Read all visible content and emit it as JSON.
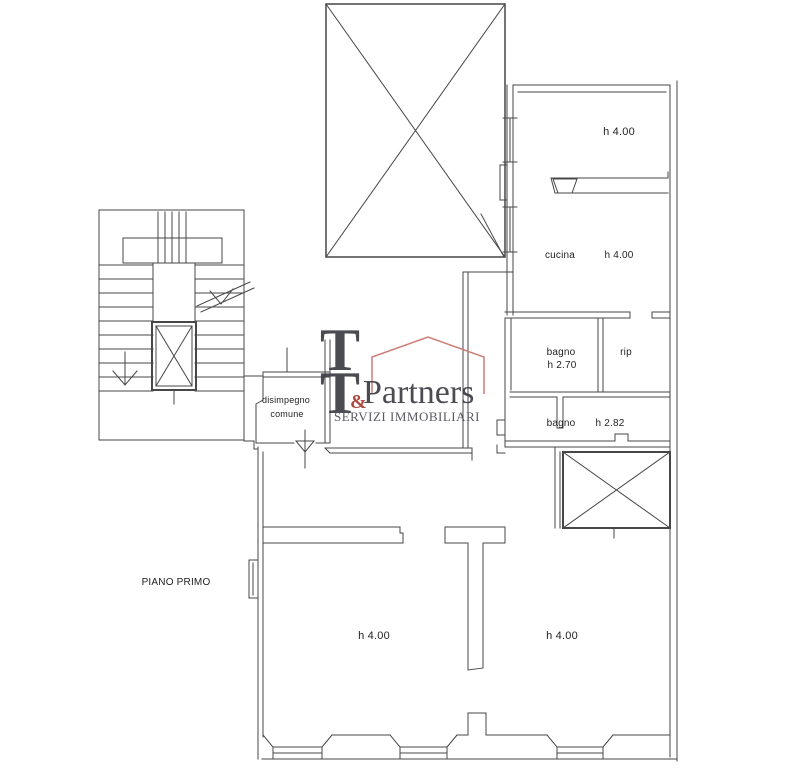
{
  "colors": {
    "bg": "#ffffff",
    "line": "#474747",
    "label": "#1f1f1f",
    "logo_dark": "#3c3c44",
    "logo_red": "#a93a32",
    "logo_house": "#cc7d75",
    "logo_sub": "#4c4c54"
  },
  "floor_label": "PIANO PRIMO",
  "rooms": {
    "top_right": {
      "height": "h 4.00"
    },
    "cucina": {
      "name": "cucina",
      "height": "h 4.00"
    },
    "bagno1": {
      "name": "bagno",
      "height": "h 2.70"
    },
    "rip": {
      "name": "rip"
    },
    "bagno2": {
      "name": "bagno",
      "height": "h 2.82"
    },
    "disimpegno": {
      "name_line1": "disimpegno",
      "name_line2": "comune"
    },
    "bottom_left": {
      "height": "h 4.00"
    },
    "bottom_right": {
      "height": "h 4.00"
    }
  },
  "watermark": {
    "t1": "T",
    "t2": "T",
    "amp": "&",
    "partners": "Partners",
    "subtitle": "SERVIZI IMMOBILIARI"
  }
}
